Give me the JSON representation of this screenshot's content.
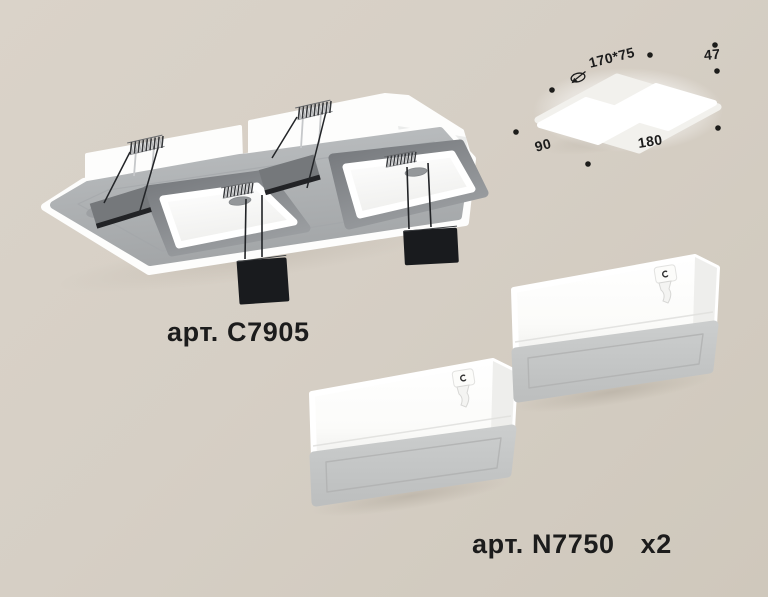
{
  "main_product": {
    "article_label": "арт. C7905"
  },
  "lamp_product": {
    "article_label": "арт. N7750",
    "quantity_label": "x2"
  },
  "dimension_diagram": {
    "cutout_size": "170*75",
    "height": "47",
    "depth": "90",
    "length": "180"
  },
  "palette": {
    "background": "#d8d1c7",
    "background_bottom": "#cfc8bc",
    "label_text": "#1c1c1c",
    "fixture_white": "#ffffff",
    "fixture_face_gray": "#b0b4b6",
    "cavity_shadow_gray": "#7d8184",
    "diffuser_gray": "#c5c7c7",
    "clip_black": "#191b1e"
  }
}
